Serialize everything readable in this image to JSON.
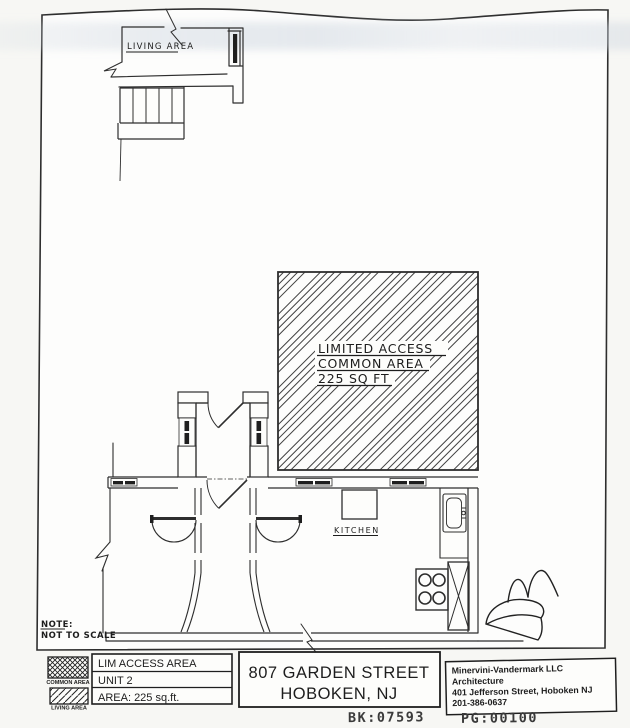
{
  "plan": {
    "living_area_label": "LIVING AREA",
    "kitchen_label": "KITCHEN",
    "hatch_label": {
      "line1": "LIMITED ACCESS",
      "line2": "COMMON AREA",
      "line3": "225 SQ FT"
    },
    "note": {
      "line1": "NOTE:",
      "line2": "NOT TO SCALE"
    }
  },
  "legend": {
    "common_area_label": "COMMON AREA",
    "living_area_label": "LIVING AREA"
  },
  "title_block": {
    "area_box": {
      "line1": "LIM ACCESS AREA",
      "line2": "UNIT 2",
      "line3": "AREA: 225 sq.ft."
    },
    "address_box": {
      "line1": "807 GARDEN STREET",
      "line2": "HOBOKEN,  NJ"
    },
    "architect_box": {
      "line1": "Minervini-Vandermark LLC",
      "line2": "Architecture",
      "line3": "401 Jefferson Street, Hoboken NJ",
      "line4": "201-386-0637"
    }
  },
  "stamp": {
    "bk": "BK:07593",
    "pg": "PG:00100"
  },
  "colors": {
    "ink": "#2e2e2e",
    "paper": "#fdfdfb",
    "scan_shadow": "#cfd7e0"
  }
}
